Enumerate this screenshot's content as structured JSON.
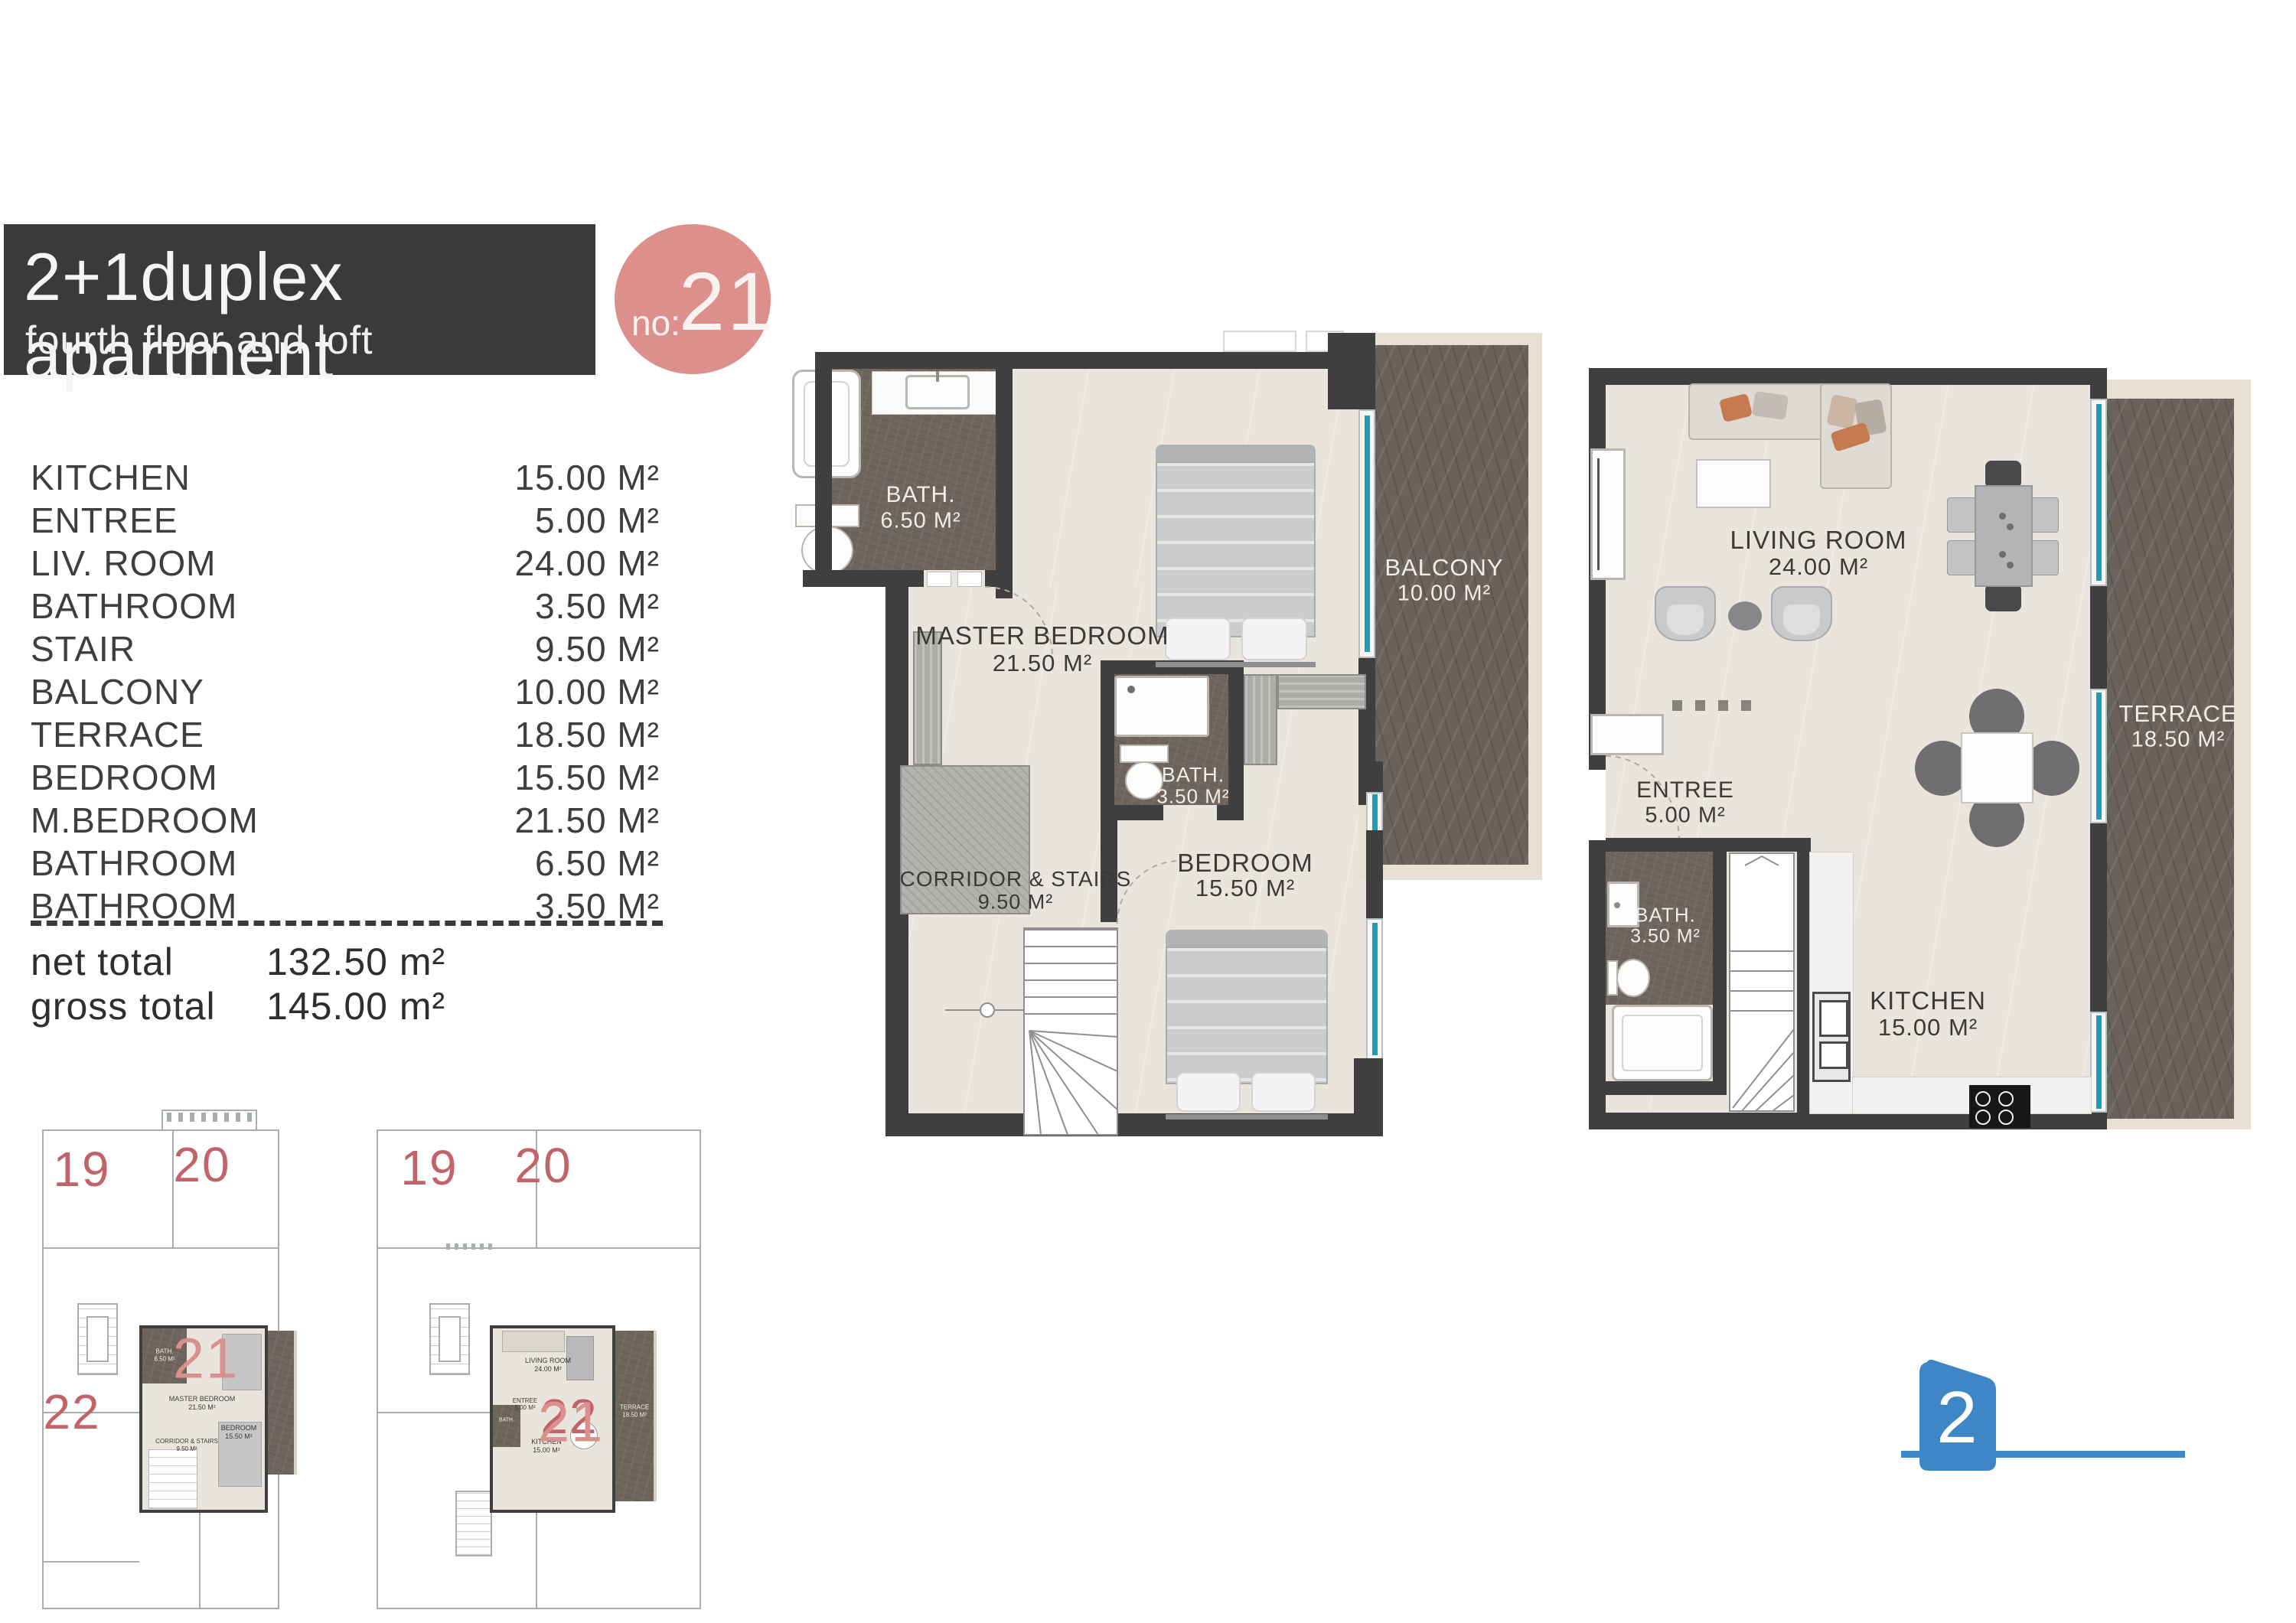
{
  "header": {
    "title": "2+1duplex apartment",
    "subtitle": "fourth floor and loft",
    "badge_prefix": "no:",
    "badge_number": "21"
  },
  "area_list": {
    "rows": [
      {
        "label": "KITCHEN",
        "value": "15.00 M²"
      },
      {
        "label": "ENTREE",
        "value": "5.00 M²"
      },
      {
        "label": "LIV. ROOM",
        "value": "24.00 M²"
      },
      {
        "label": "BATHROOM",
        "value": "3.50 M²"
      },
      {
        "label": "STAIR",
        "value": "9.50 M²"
      },
      {
        "label": "BALCONY",
        "value": "10.00 M²"
      },
      {
        "label": "TERRACE",
        "value": "18.50 M²"
      },
      {
        "label": "BEDROOM",
        "value": "15.50 M²"
      },
      {
        "label": "M.BEDROOM",
        "value": "21.50 M²"
      },
      {
        "label": "BATHROOM",
        "value": "6.50 M²"
      },
      {
        "label": "BATHROOM",
        "value": "3.50 M²"
      }
    ],
    "totals": [
      {
        "label": "net total",
        "value": "132.50 m²"
      },
      {
        "label": "gross total",
        "value": "145.00 m²"
      }
    ]
  },
  "plan_fourth": {
    "rooms": {
      "bath_big": {
        "name": "BATH.",
        "area": "6.50 M²"
      },
      "master": {
        "name": "MASTER BEDROOM",
        "area": "21.50 M²"
      },
      "balcony": {
        "name": "BALCONY",
        "area": "10.00 M²"
      },
      "bath_small": {
        "name": "BATH.",
        "area": "3.50 M²"
      },
      "corridor": {
        "name": "CORRIDOR & STAIRS",
        "area": "9.50 M²"
      },
      "bedroom": {
        "name": "BEDROOM",
        "area": "15.50 M²"
      }
    }
  },
  "plan_loft": {
    "rooms": {
      "living": {
        "name": "LIVING ROOM",
        "area": "24.00 M²"
      },
      "terrace": {
        "name": "TERRACE",
        "area": "18.50 M²"
      },
      "entree": {
        "name": "ENTREE",
        "area": "5.00 M²"
      },
      "bath": {
        "name": "BATH.",
        "area": "3.50 M²"
      },
      "kitchen": {
        "name": "KITCHEN",
        "area": "15.00 M²"
      }
    }
  },
  "key_plans": {
    "fourth": {
      "units": [
        {
          "number": "19"
        },
        {
          "number": "20"
        },
        {
          "number": "22"
        }
      ],
      "highlight": "21"
    },
    "loft": {
      "units": [
        {
          "number": "19"
        },
        {
          "number": "20"
        },
        {
          "number": "22"
        }
      ],
      "highlight": "21"
    }
  },
  "page_marker": {
    "number": "2"
  },
  "colors": {
    "title_box": "#3a3a3a",
    "accent_pink": "#dd8f8c",
    "wall": "#3f3f3f",
    "tile": "#6e655d",
    "window_teal": "#1f9cba",
    "floor_beige": "#e9e4dc",
    "frame_light": "#e8e1d3",
    "unit_number_red": "#c2636a",
    "marker_blue": "#3e86c6"
  }
}
